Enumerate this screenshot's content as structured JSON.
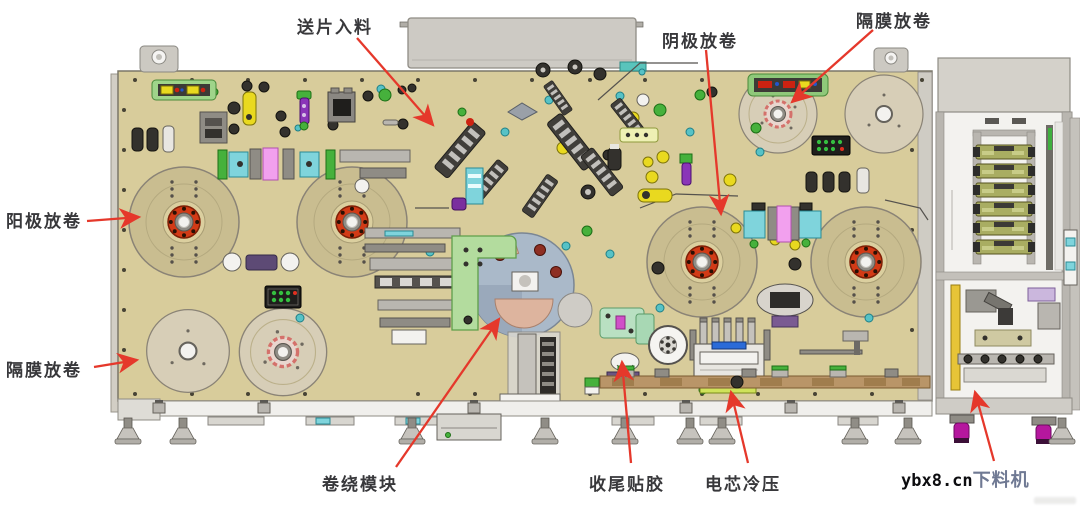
{
  "colors": {
    "arrow_red": "#e5382b",
    "bed_tan": "#d8cc9b",
    "reel_tan": "#c9bd90",
    "reel_hub_red": "#d23a16",
    "turret_blue_gray": "#aab9c9",
    "bracket_green": "#b3dc9e",
    "label_dark": "#38383b",
    "unloader_label_gray": "#6f7993",
    "cabinet_gray": "#d4d1ca"
  },
  "callouts": [
    {
      "id": "feed-in",
      "label": "送片入料"
    },
    {
      "id": "anode-unwind",
      "label": "阳极放卷"
    },
    {
      "id": "separator-unwind-left",
      "label": "隔膜放卷"
    },
    {
      "id": "cathode-unwind",
      "label": "阴极放卷"
    },
    {
      "id": "separator-unwind-right",
      "label": "隔膜放卷"
    },
    {
      "id": "winding-module",
      "label": "卷绕模块"
    },
    {
      "id": "tail-taping",
      "label": "收尾贴胶"
    },
    {
      "id": "cell-cold-press",
      "label": "电芯冷压"
    },
    {
      "id": "unloader",
      "label": "下料机"
    }
  ],
  "watermark": {
    "text": "ybx8.cn"
  }
}
